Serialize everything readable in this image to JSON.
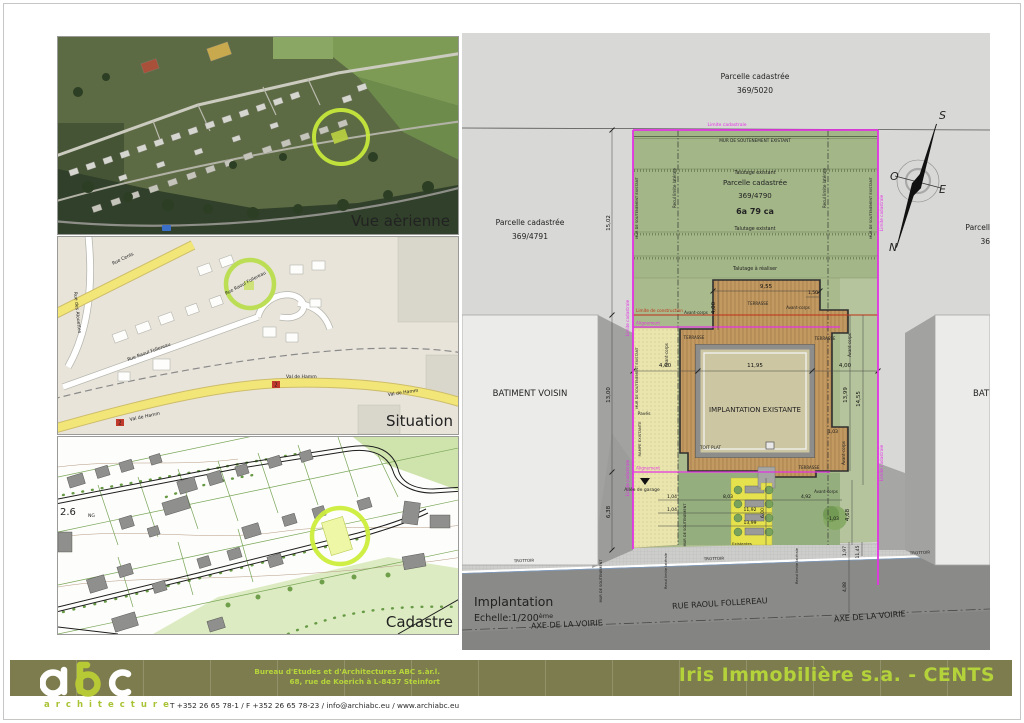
{
  "colors": {
    "limit_magenta": "#e433e4",
    "construction_red": "#c03018",
    "highlight_green": "#cdee3c",
    "footer_olive": "#7c7c4e",
    "brand_green": "#b4d23a"
  },
  "panels": {
    "aerial": {
      "caption": "Vue aèrienne"
    },
    "situation": {
      "caption": "Situation",
      "rue_cents": "Rue Cents",
      "rue_des_alouettes": "Rue des Alouettes",
      "rue_raoul_follereau": "Rue Raoul Follereau",
      "val_de_hamm": "Val de Hamm",
      "route_badge": "2"
    },
    "cadastre": {
      "caption": "Cadastre",
      "note_scale": "2.6",
      "note_ng": "NG"
    }
  },
  "plan": {
    "parcel_top": {
      "l1": "Parcelle cadastrée",
      "l2": "369/5020"
    },
    "parcel_left": {
      "l1": "Parcelle cadastrée",
      "l2": "369/4791"
    },
    "parcel_site": {
      "l1": "Parcelle cadastrée",
      "l2": "369/4790",
      "area": "6a 79 ca"
    },
    "parcel_right": {
      "l1": "Parcell",
      "l2": "36"
    },
    "compass": {
      "n": "N",
      "s": "S",
      "e": "E",
      "o": "O"
    },
    "labels": {
      "limite_cadastrale": "Limite cadastrale",
      "mur_soutenement_existant": "MUR DE SOUTENEMENT EXISTANT",
      "mur_soutenement": "MUR DE SOUTENEMENT",
      "talutage_existant": "Talutage existant",
      "talutage_a_realiser": "Talutage à réaliser",
      "recul_limite_laterale": "Recul limite latérale",
      "limite_de_construction": "Limite de construction",
      "alignement": "Alignement",
      "avant_corps": "Avant-corps",
      "terrasse": "TERRASSE",
      "batiment_voisin": "BATIMENT VOISIN",
      "implantation_existante": "IMPLANTATION EXISTANTE",
      "toit_plat": "TOIT PLAT",
      "paves": "Pavés",
      "rampe_existante": "RAMPE EXISTANTE",
      "allee_de_garage": "Allée de garage",
      "existantes": "Existantes",
      "trottoir": "TROTTOIR",
      "rue_raoul_follereau": "RUE RAOUL FOLLEREAU",
      "axe_de_la_voirie": "AXE DE LA VOIRIE"
    },
    "dims": {
      "left_top": "15,02",
      "left_mid": "13,00",
      "left_bottom": "6,38",
      "deck_width": "9,55",
      "deck_depth": "4,00",
      "deck_step": "1,50",
      "front_left": "4,00",
      "front_center": "11,95",
      "front_right": "4,00",
      "right_a": "13,99",
      "right_b": "14,55",
      "right_c": "1,03",
      "tree_offset": "1,03",
      "tree_height": "4,68",
      "park_a": "1,04",
      "park_b": "1,04",
      "park_c": "8,03",
      "park_d": "11,92",
      "park_e": "13,99",
      "park_f": "6,00",
      "park_g": "4,92",
      "street_a": "1,97",
      "street_b": "11,45",
      "street_c": "4,88"
    },
    "title_block": {
      "title": "Implantation",
      "scale": "Echelle:1/200",
      "scale_sup": "ème"
    }
  },
  "footer": {
    "logo_text": "abc",
    "logo_sub": "architecture",
    "company_line1": "Bureau d'Etudes et d'Architectures ABC s.àr.l.",
    "company_line2": "68, rue de Koerich à L-8437 Steinfort",
    "contact_line": "T  +352 26 65 78-1 / F  +352 26 65 78-23 / info@archiabc.eu / www.archiabc.eu",
    "project_title": "Iris Immobilière s.a. - CENTS"
  }
}
